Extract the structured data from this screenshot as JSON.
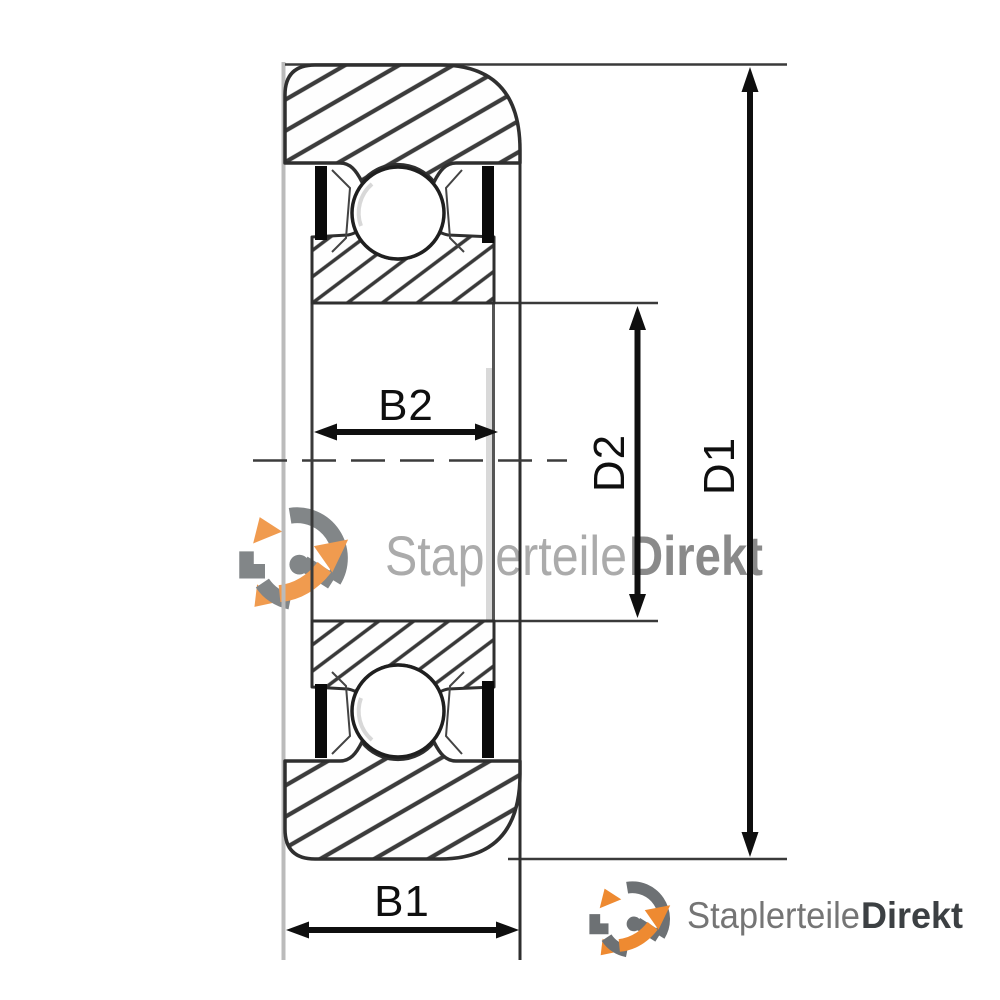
{
  "page": {
    "kind": "technical-drawing",
    "subject": "sealed ball bearing / mast roller cross-section with dimension callouts"
  },
  "labels": {
    "b2": "B2",
    "b1": "B1",
    "d2": "D2",
    "d1": "D1"
  },
  "watermark": {
    "brand_regular": "Staplerteile",
    "brand_bold": "Direkt"
  },
  "footer_logo": {
    "brand_regular": "Staplerteile",
    "brand_bold": "Direkt"
  },
  "icons": {
    "logo": "staplerteile-circular-arrows-logo"
  },
  "colors": {
    "accent_orange": "#EE8A31",
    "logo_gray": "#6D7174",
    "brand_text_gray": "#7A7A7A",
    "brand_text_dark": "#3C4043",
    "drawing_line": "#343434",
    "dimension_black": "#0F0F0F",
    "light_edge_gray": "#BBBBBB",
    "background": "#FFFFFF"
  }
}
